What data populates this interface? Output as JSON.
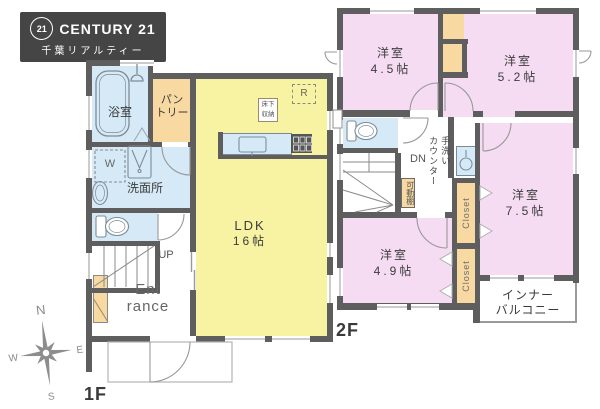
{
  "logo": {
    "number": "21",
    "brand": "CENTURY 21",
    "subtitle": "千葉リアルティー"
  },
  "floor1": {
    "label": "1F",
    "bathroom": "浴室",
    "pantry_line1": "パン",
    "pantry_line2": "トリー",
    "washroom": "洗面所",
    "washer": "W",
    "ldk": "LDK",
    "ldk_size": "16帖",
    "floor_storage_line1": "床下",
    "floor_storage_line2": "収納",
    "fridge": "R",
    "stairs_up": "UP",
    "entrance_line1": "Ent",
    "entrance_line2": "rance"
  },
  "floor2": {
    "label": "2F",
    "room_tl_name": "洋室",
    "room_tl_size": "4.5帖",
    "room_tr_name": "洋室",
    "room_tr_size": "5.2帖",
    "room_r_name": "洋室",
    "room_r_size": "7.5帖",
    "room_bl_name": "洋室",
    "room_bl_size": "4.9帖",
    "stairs_down": "DN",
    "handwash_line1": "手洗い",
    "handwash_line2": "カウンター",
    "movable_shelf": "可動棚",
    "closet_top": "Closet",
    "closet_bottom": "Closet",
    "balcony_line1": "インナー",
    "balcony_line2": "バルコニー"
  },
  "compass": {
    "north": "N",
    "east": "E",
    "south": "S",
    "west": "W"
  },
  "colors": {
    "wall": "#5e5e5e",
    "room_yellow": "#f8f3a3",
    "room_blue": "#d5eaf6",
    "room_orange": "#f7d9a1",
    "room_pink": "#f5dcf2",
    "logo_bg": "#454545"
  }
}
